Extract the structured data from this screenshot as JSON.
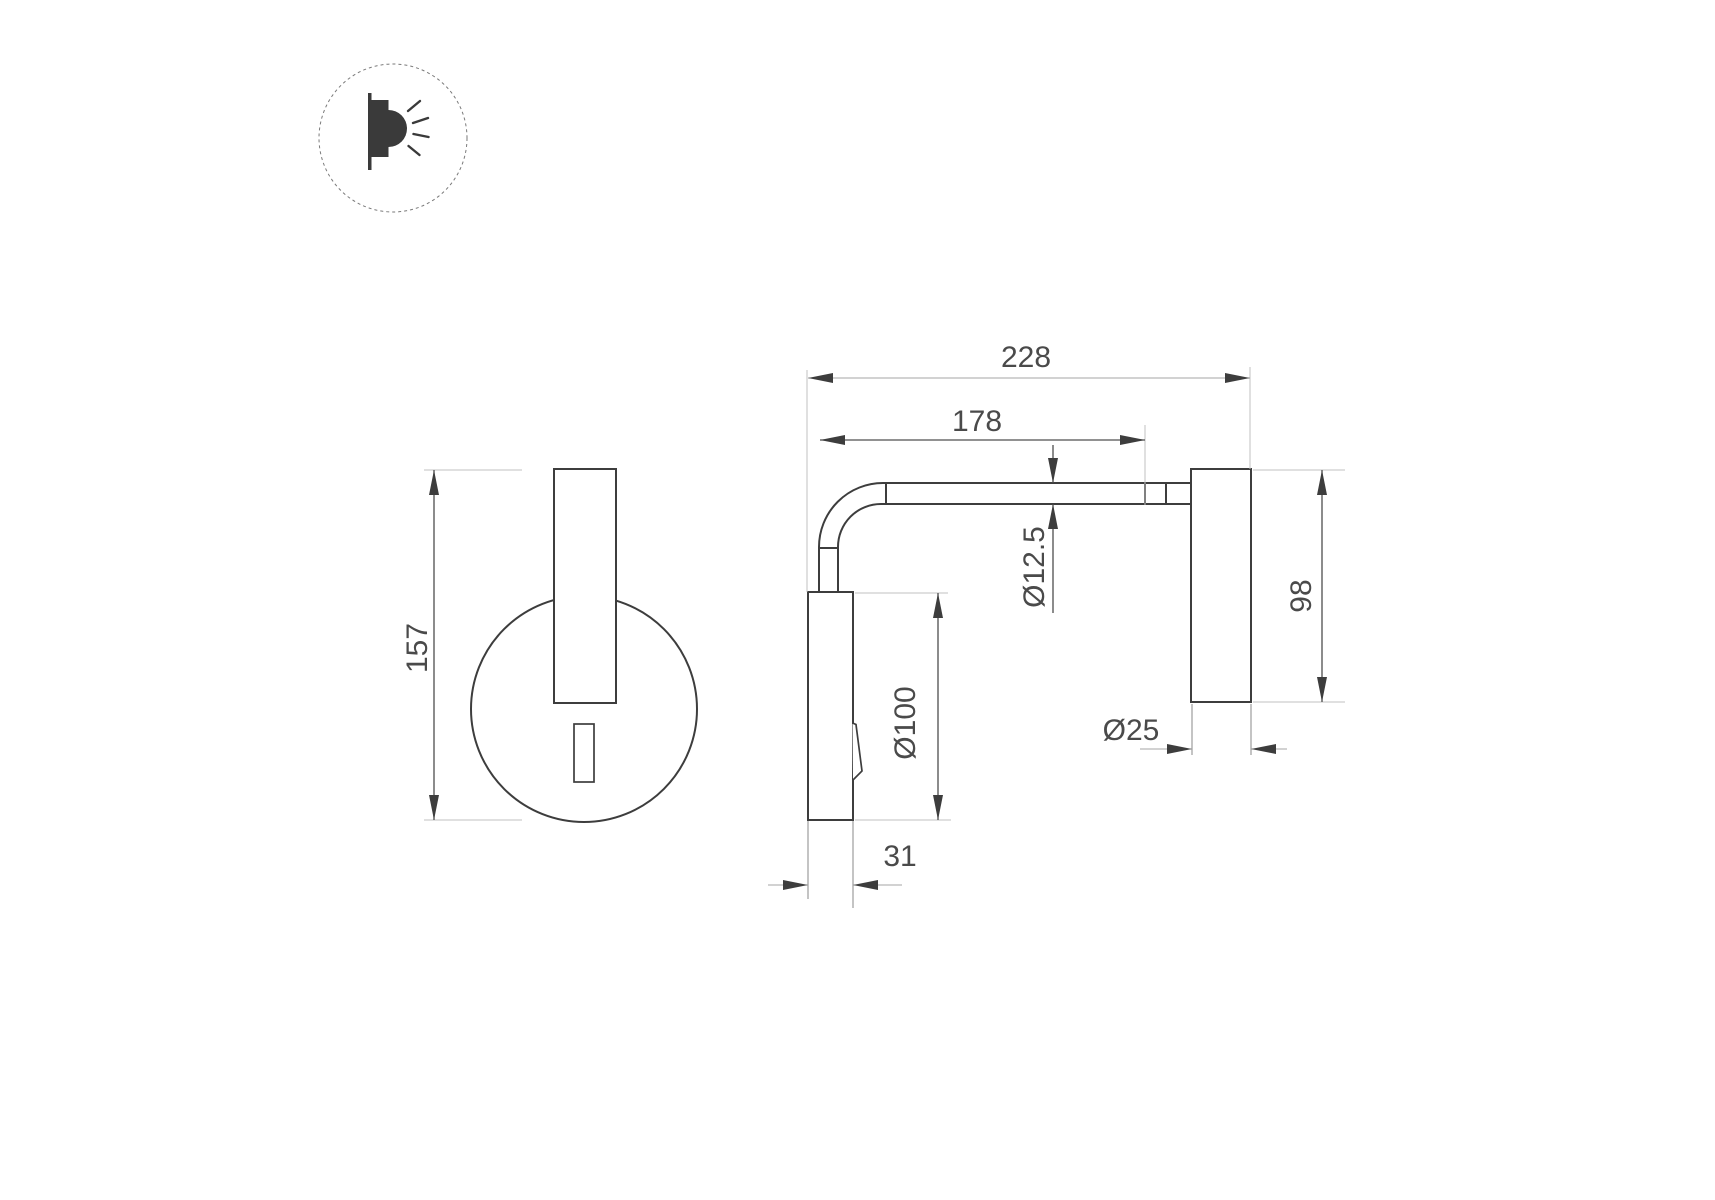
{
  "drawing": {
    "type": "technical-drawing",
    "subject": "wall-mounted reading lamp, two orthographic views with dimensions",
    "colors": {
      "background": "#ffffff",
      "object_line": "#3d3d3d",
      "dimension_line": "#4f4f4f",
      "light_dimension_line": "#a6a6a6",
      "extension_line": "#c2c2c2",
      "text": "#4a4a4a"
    },
    "logo": {
      "icon": "wall-light-icon"
    },
    "dimensions": {
      "front_overall_height": "157",
      "side_overall_length": "228",
      "side_arm_length": "178",
      "side_tube_diameter": "Ø12.5",
      "side_plate_diameter": "Ø100",
      "side_head_height": "98",
      "side_head_diameter": "Ø25",
      "side_plate_depth": "31"
    }
  }
}
